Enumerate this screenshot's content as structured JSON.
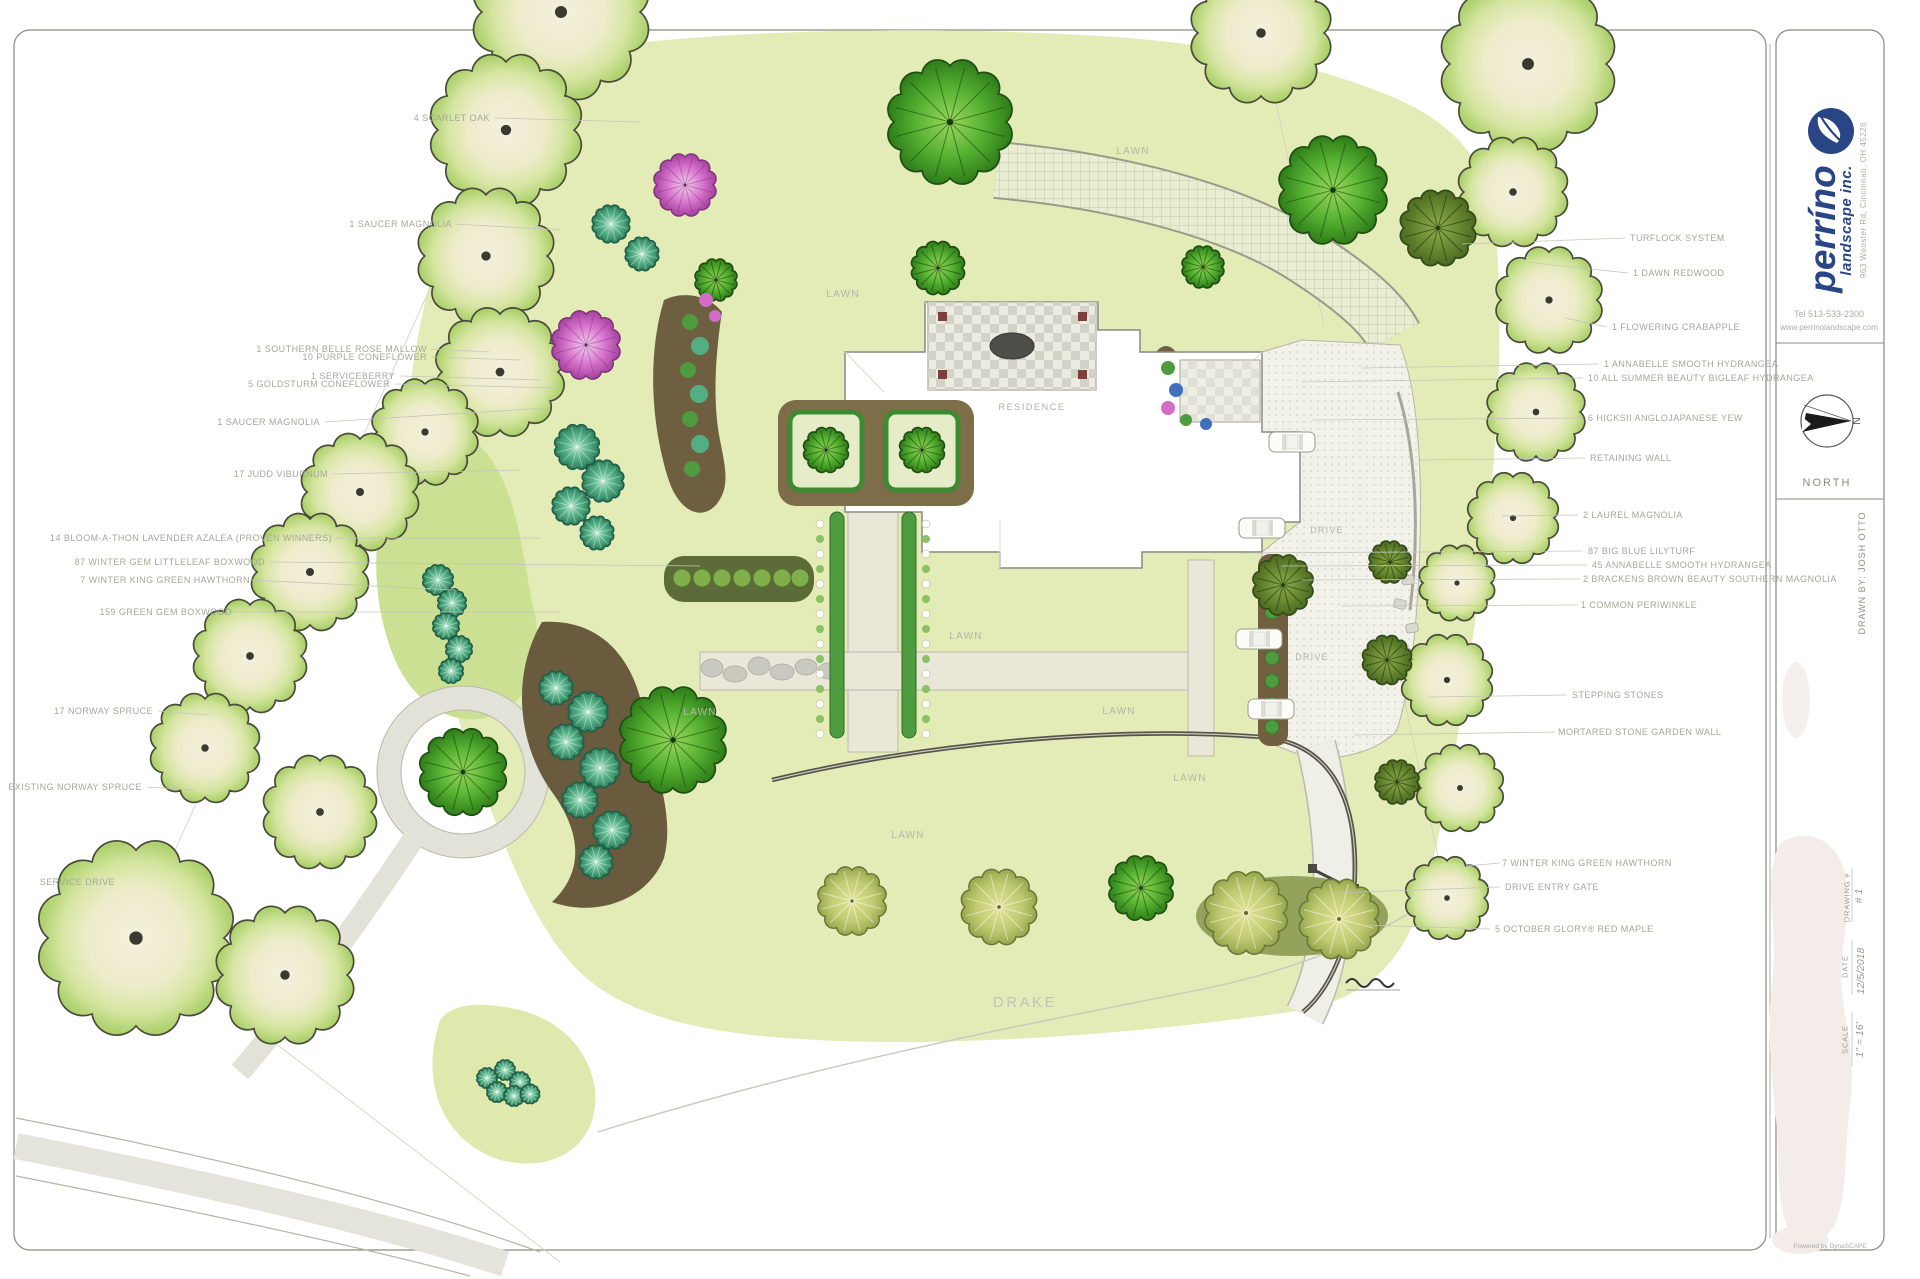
{
  "plan_texts": {
    "lawn": "LAWN",
    "residence": "RESIDENCE",
    "drive": "DRIVE",
    "street_name": "DRAKE"
  },
  "labels": {
    "left": [
      "4 SCARLET OAK",
      "1 SAUCER MAGNOLIA",
      "1 SOUTHERN BELLE ROSE MALLOW",
      "10 PURPLE CONEFLOWER",
      "1 SERVICEBERRY",
      "5 GOLDSTURM CONEFLOWER",
      "1 SAUCER MAGNOLIA",
      "17 JUDD VIBURNUM",
      "14 BLOOM-A-THON LAVENDER AZALEA (Proven Winners)",
      "87 WINTER GEM LITTLELEAF BOXWOOD",
      "7 WINTER KING GREEN HAWTHORN",
      "159 GREEN GEM BOXWOOD",
      "17 NORWAY SPRUCE",
      "EXISTING NORWAY SPRUCE",
      "SERVICE DRIVE"
    ],
    "right": [
      "TURFLOCK SYSTEM",
      "1 DAWN REDWOOD",
      "1 FLOWERING CRABAPPLE",
      "1 ANNABELLE SMOOTH HYDRANGEA",
      "10 ALL SUMMER BEAUTY BIGLEAF HYDRANGEA",
      "6 HICKSII ANGLOJAPANESE YEW",
      "RETAINING WALL",
      "2 LAUREL MAGNOLIA",
      "87 BIG BLUE LILYTURF",
      "45 ANNABELLE SMOOTH HYDRANGEA",
      "2 BRACKENS BROWN BEAUTY SOUTHERN MAGNOLIA",
      "1 COMMON PERIWINKLE",
      "STEPPING STONES",
      "MORTARED STONE GARDEN WALL",
      "7 WINTER KING GREEN HAWTHORN",
      "DRIVE ENTRY GATE",
      "5 OCTOBER GLORY® RED MAPLE"
    ]
  },
  "title_block": {
    "brand": {
      "name": "perríno",
      "tagline": "landscape inc.",
      "address": "963 Wooster Rd, Cincinnati, OH 45226",
      "tel": "Tel 513-533-2300",
      "website": "www.perrinolandscape.com"
    },
    "compass": {
      "n": "N",
      "label": "NORTH"
    },
    "drawn_by": "DRAWN BY:  JOSH OTTO",
    "drawing_no_label": "DRAWING #",
    "drawing_no": "# 1",
    "date_label": "DATE",
    "date": "12/5/2018",
    "scale_label": "SCALE",
    "scale": "1\" = 16'",
    "credit": "Powered by DynaSCAPE"
  },
  "colors": {
    "lawn": "#e3ecb6",
    "lawn_dark": "#cbe092",
    "canopy_edge": "#abd06a",
    "bed_brown": "#6f5f41",
    "brand_navy": "#2a4585",
    "label_gray": "#a6a69c",
    "pink_tree": "#d878cf",
    "evergreen": "#2f7e1a"
  }
}
